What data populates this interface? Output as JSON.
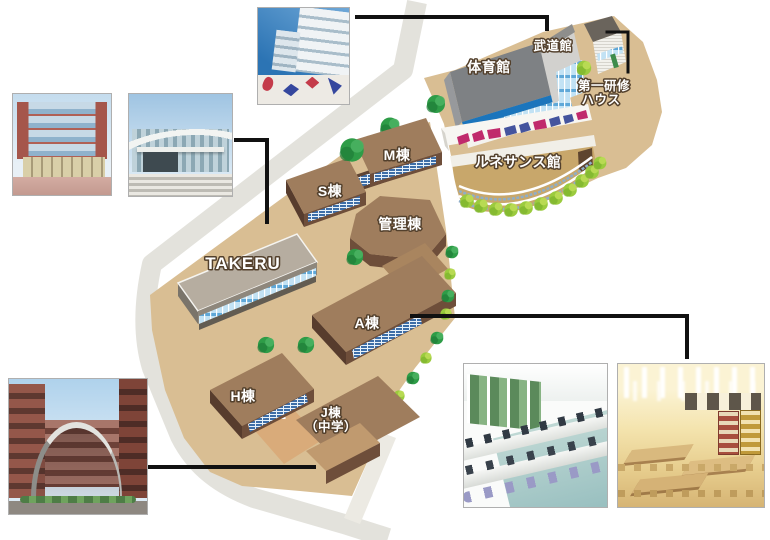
{
  "map_labels": {
    "taiikukan": "体育館",
    "budokan": "武道館",
    "daiichi_kenshu_line1": "第一研修",
    "daiichi_kenshu_line2": "ハウス",
    "renaissance": "ルネサンス館",
    "m_building": "M棟",
    "s_building": "S棟",
    "kanri_building": "管理棟",
    "takeru": "TAKERU",
    "a_building": "A棟",
    "h_building": "H棟",
    "j_building_line1": "J棟",
    "j_building_line2": "（中学）"
  },
  "buildings": [
    {
      "id": "taiikukan",
      "label": "体育館"
    },
    {
      "id": "budokan",
      "label": "武道館"
    },
    {
      "id": "daiichi-kenshu-house",
      "label": "第一研修ハウス"
    },
    {
      "id": "renaissance-kan",
      "label": "ルネサンス館"
    },
    {
      "id": "m-building",
      "label": "M棟"
    },
    {
      "id": "s-building",
      "label": "S棟"
    },
    {
      "id": "kanri-building",
      "label": "管理棟"
    },
    {
      "id": "takeru",
      "label": "TAKERU"
    },
    {
      "id": "a-building",
      "label": "A棟"
    },
    {
      "id": "h-building",
      "label": "H棟"
    },
    {
      "id": "j-building-junior-high",
      "label": "J棟（中学）"
    }
  ],
  "photos": [
    {
      "name": "glass-front-brick-building-photo"
    },
    {
      "name": "curved-roof-hall-photo"
    },
    {
      "name": "high-rise-with-sports-mural-photo"
    },
    {
      "name": "brick-building-arched-gate-photo"
    },
    {
      "name": "computer-lab-interior-photo"
    },
    {
      "name": "cafeteria-interior-photo"
    }
  ],
  "colors": {
    "ground_tan": "#D9BE93",
    "road_gray": "#E3E2DC",
    "building_brown_roof": "#9F7D5D",
    "building_brown_wall": "#6E4E3A",
    "building_brown_side": "#573C2D",
    "takeru_gray": "#B6ADA0",
    "gym_gray": "#7E8184",
    "window_blue": "#3D6EA8",
    "glass_blue": "#C2E2F4",
    "band_blue": "#1B75BC",
    "mosaic_magenta": "#C02A6C",
    "mosaic_indigo": "#44549E",
    "tree_green": "#2E9C47",
    "bush_green": "#9BCB3E",
    "connector_black": "#111111"
  }
}
